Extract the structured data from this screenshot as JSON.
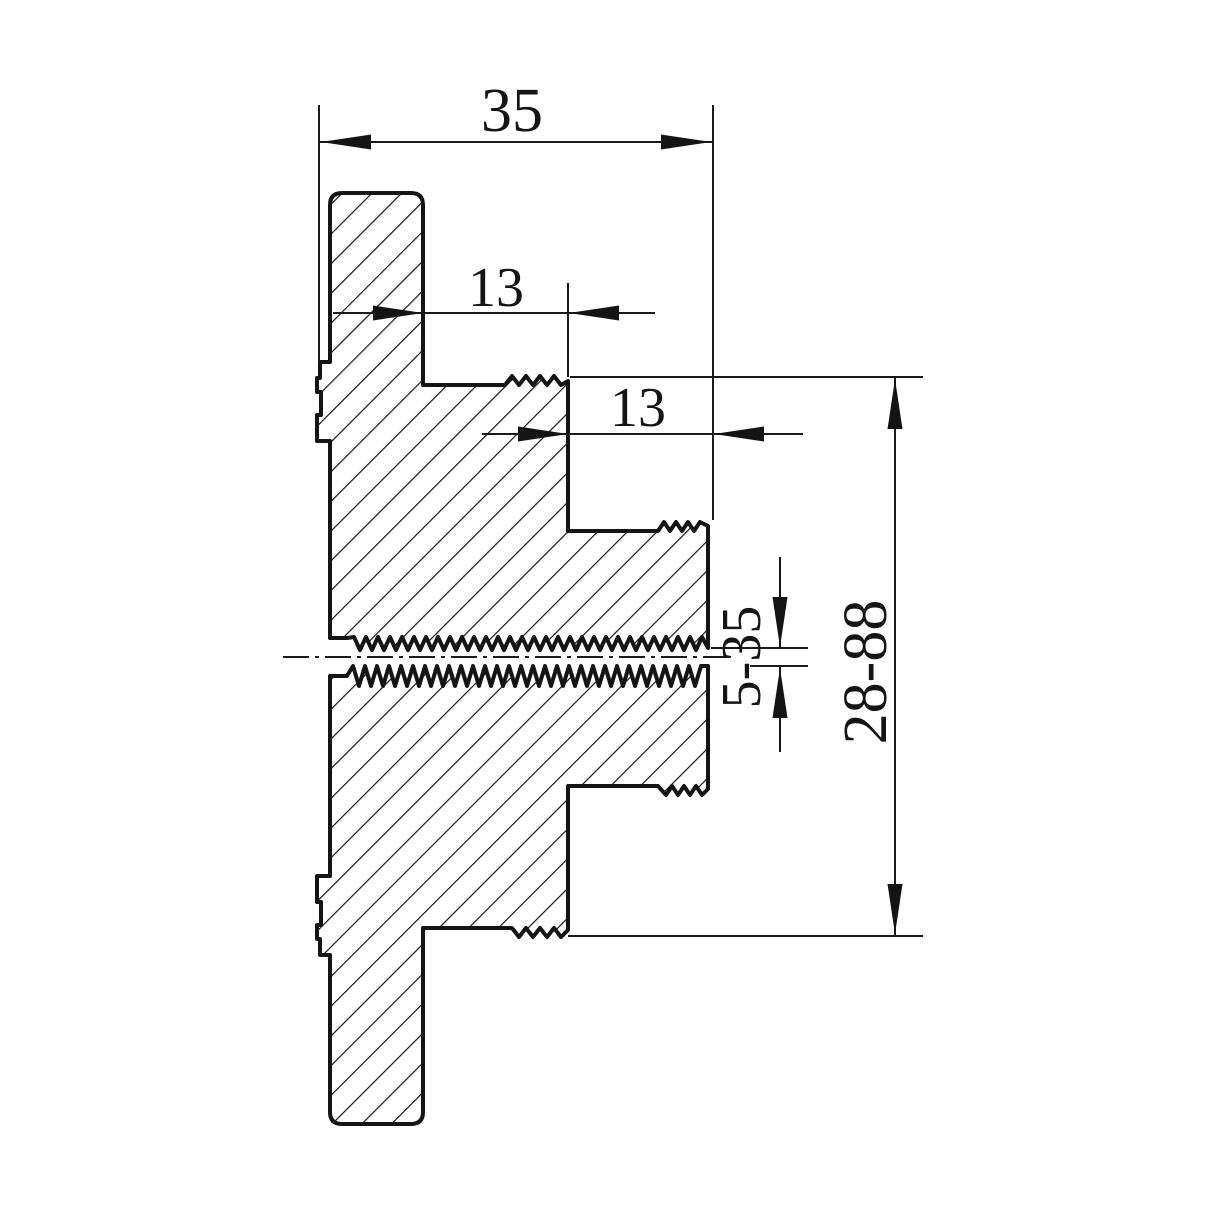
{
  "drawing": {
    "type": "engineering-section-view",
    "description": "Cross-section of a stepped threaded flange adapter with hatched cut surfaces",
    "colors": {
      "line": "#141414",
      "background": "#ffffff"
    },
    "dimensions": {
      "overall_width": "35",
      "step_depth_1": "13",
      "step_depth_2": "13",
      "bore_range": "5-35",
      "flange_range": "28-88"
    }
  }
}
